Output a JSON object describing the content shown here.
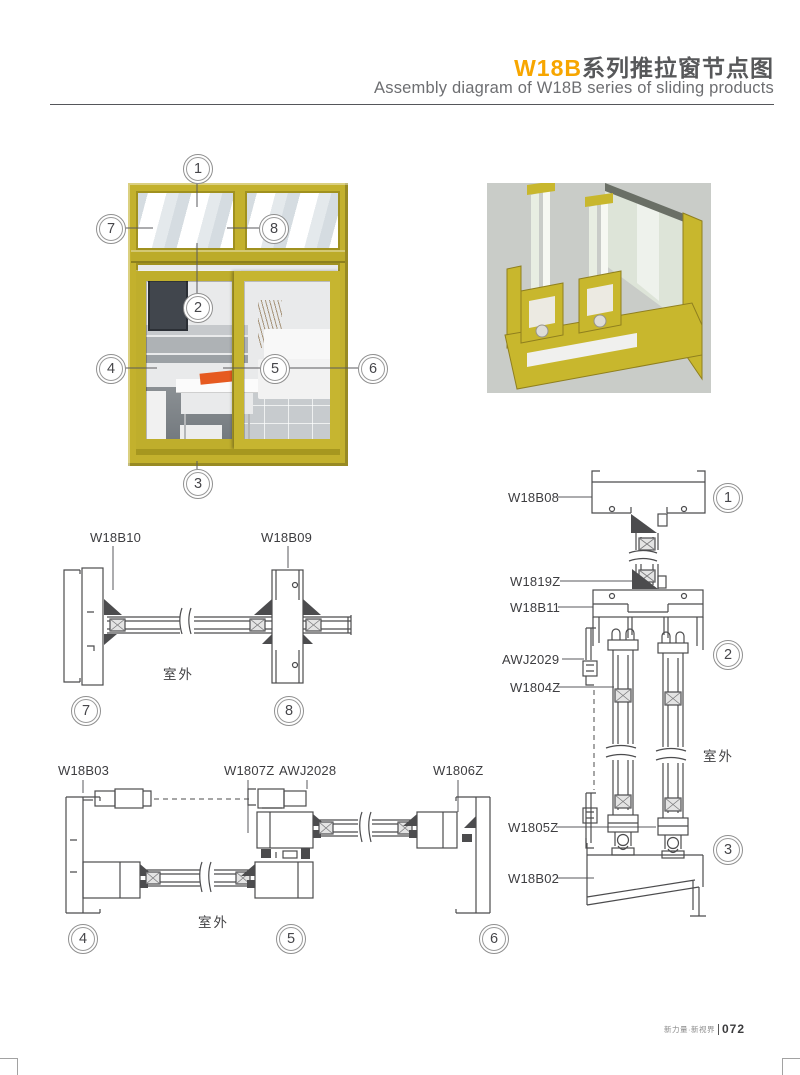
{
  "header": {
    "title_accent": "W18B",
    "title_zh": "系列推拉窗节点图",
    "subtitle": "Assembly diagram of W18B series of sliding products"
  },
  "callouts": {
    "n1": "1",
    "n2": "2",
    "n3": "3",
    "n4": "4",
    "n5": "5",
    "n6": "6",
    "n7": "7",
    "n8": "8"
  },
  "labels": {
    "outdoor": "室外",
    "w18b10": "W18B10",
    "w18b09": "W18B09",
    "w18b08": "W18B08",
    "w1819z": "W1819Z",
    "w18b11": "W18B11",
    "awj2029": "AWJ2029",
    "w1804z": "W1804Z",
    "w1805z": "W1805Z",
    "w18b02": "W18B02",
    "w18b03": "W18B03",
    "w1807z": "W1807Z",
    "awj2028": "AWJ2028",
    "w1806z": "W1806Z"
  },
  "footer": {
    "tagline": "新力量·新视界",
    "page_number": "072"
  },
  "colors": {
    "accent_orange": "#F7A600",
    "title_gray": "#57585A",
    "subtitle_gray": "#6D6E71",
    "frame_yellow": "#C3B12D",
    "drawing_line": "#4C4C4E",
    "render_bg": "#C9CCC8"
  }
}
